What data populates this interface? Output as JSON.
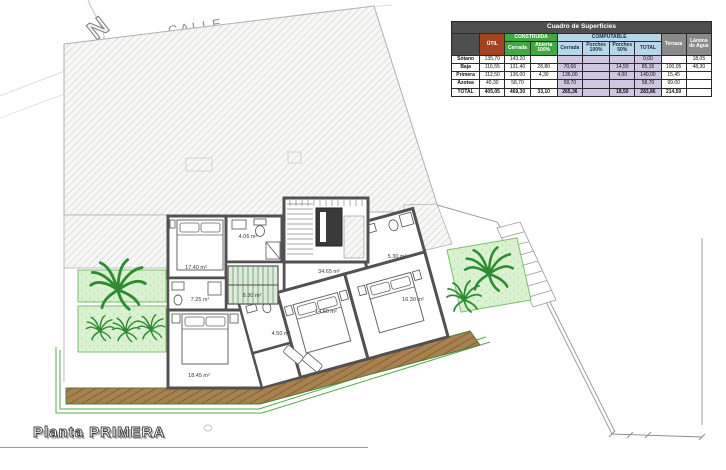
{
  "title": {
    "label": "Planta PRIMERA"
  },
  "site": {
    "street_label": "CALLE",
    "north_label": "N"
  },
  "table": {
    "title": "Cuadro de Superficies",
    "groups": {
      "construida": "CONSTRUIDA",
      "computable": "COMPUTABLE"
    },
    "cols": {
      "util": "ÚTIL",
      "cons_cerrada": "Cerrada",
      "cons_abierta": "Abierta 100%",
      "comp_cerrada": "Cerrada",
      "porches100": "Porches 100%",
      "porches50": "Porches 50%",
      "comp_total": "TOTAL",
      "terraza": "Terraza",
      "lamina": "Lámina de Agua"
    },
    "rows": [
      {
        "cells": [
          "Sótano",
          "135,70",
          "143,20",
          "",
          "",
          "",
          "",
          "0,00",
          "",
          "18,05"
        ]
      },
      {
        "cells": [
          "Baja",
          "116,55",
          "131,40",
          "28,80",
          "70,66",
          "",
          "14,50",
          "85,16",
          "100,05",
          "48,30"
        ]
      },
      {
        "cells": [
          "Primera",
          "112,50",
          "136,00",
          "4,30",
          "136,00",
          "",
          "4,00",
          "140,00",
          "15,45",
          ""
        ]
      },
      {
        "cells": [
          "Azotea",
          "40,30",
          "58,70",
          "",
          "58,70",
          "",
          "",
          "58,70",
          "99,00",
          ""
        ]
      },
      {
        "cells": [
          "TOTAL",
          "405,05",
          "469,30",
          "33,10",
          "265,36",
          "",
          "18,50",
          "283,86",
          "214,50",
          ""
        ]
      }
    ]
  },
  "plan": {
    "rooms": [
      {
        "name": "bedroom-1",
        "area": "17.40 m²"
      },
      {
        "name": "bath-1",
        "area": "4.06 m²"
      },
      {
        "name": "hall",
        "area": "8.30 m²"
      },
      {
        "name": "laundry-bath",
        "area": "7.25 m²"
      },
      {
        "name": "bedroom-2",
        "area": "18.45 m²"
      },
      {
        "name": "landing",
        "area": "34.65 m²"
      },
      {
        "name": "bath-2",
        "area": "5.30 m²"
      },
      {
        "name": "bedroom-3",
        "area": "14.60 m²"
      },
      {
        "name": "bedroom-4",
        "area": "16.30 m²"
      },
      {
        "name": "bath-3",
        "area": "4.50 m²"
      }
    ]
  },
  "colors": {
    "wall": "#515151",
    "hatch_line": "#c8c8c4",
    "deck": "#a8824e",
    "deck_line": "#7c5c2f",
    "garden": "#daf2cf",
    "plant": "#2e8b33",
    "trim": "#5aa84d",
    "table_title_bg": "#4f4f4f",
    "util_bg": "#a2441f",
    "construida_bg": "#43a843",
    "computable_bg": "#b8d6ea",
    "computable_cell_bg": "#cfc6e2",
    "gray_header_bg": "#8a8a8a"
  }
}
